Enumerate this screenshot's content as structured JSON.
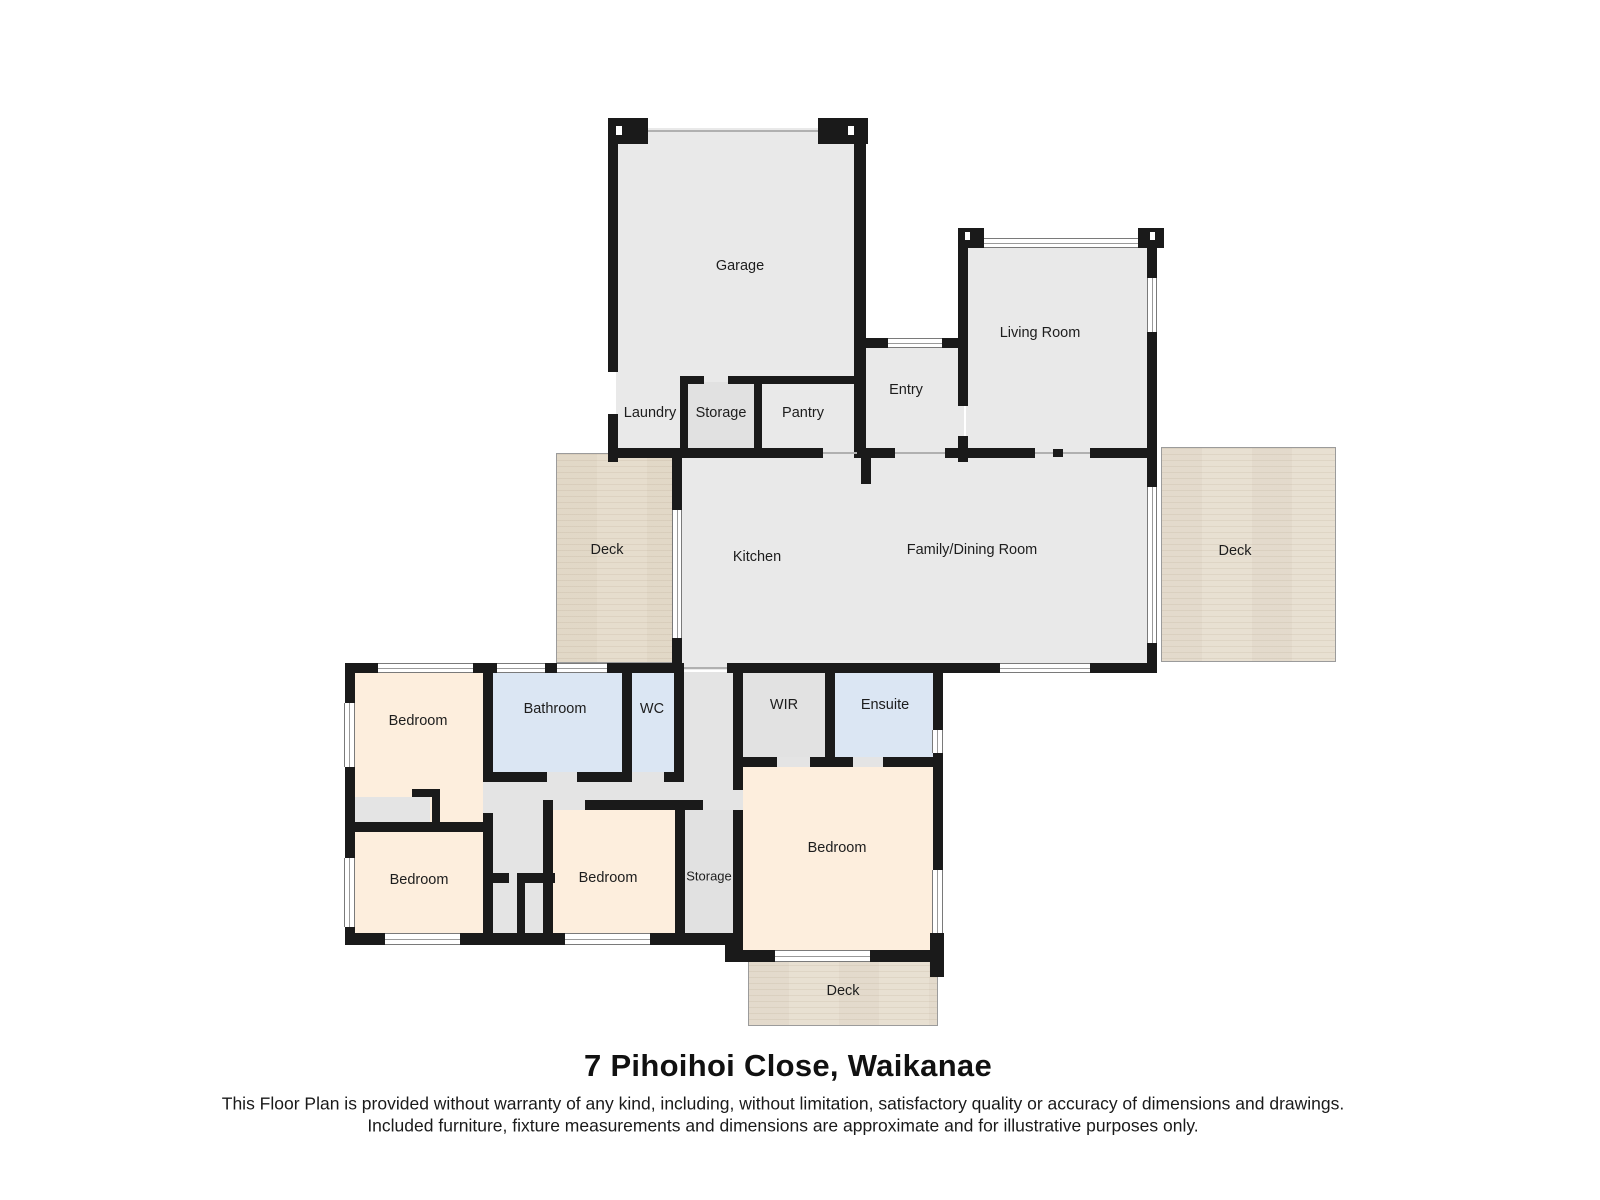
{
  "title": "7 Pihoihoi Close, Waikanae",
  "disclaimer": {
    "line1": "This Floor Plan is provided without warranty of any kind, including, without limitation, satisfactory quality or accuracy of dimensions and drawings.",
    "line2": "Included furniture, fixture measurements and dimensions are approximate and for illustrative purposes only."
  },
  "rooms": {
    "garage": {
      "label": "Garage"
    },
    "living_room": {
      "label": "Living Room"
    },
    "entry": {
      "label": "Entry"
    },
    "laundry": {
      "label": "Laundry"
    },
    "storage_upper": {
      "label": "Storage"
    },
    "pantry": {
      "label": "Pantry"
    },
    "deck_left": {
      "label": "Deck"
    },
    "kitchen": {
      "label": "Kitchen"
    },
    "family_dining": {
      "label": "Family/Dining Room"
    },
    "deck_right": {
      "label": "Deck"
    },
    "bedroom_1": {
      "label": "Bedroom"
    },
    "bathroom": {
      "label": "Bathroom"
    },
    "wc": {
      "label": "WC"
    },
    "wir": {
      "label": "WIR"
    },
    "ensuite": {
      "label": "Ensuite"
    },
    "bedroom_master": {
      "label": "Bedroom"
    },
    "bedroom_2": {
      "label": "Bedroom"
    },
    "bedroom_3": {
      "label": "Bedroom"
    },
    "storage_lower": {
      "label": "Storage"
    },
    "deck_bottom": {
      "label": "Deck"
    }
  },
  "colors": {
    "wall": "#1a1a1a",
    "room_gray": "#e9e9e9",
    "hall_gray": "#e4e4e4",
    "utility_gray": "#e1e1e1",
    "bedroom_cream": "#fdeedd",
    "bath_blue": "#dbe6f3",
    "deck_beige": "#e8e0d2",
    "window_line": "#7a7a7a"
  }
}
